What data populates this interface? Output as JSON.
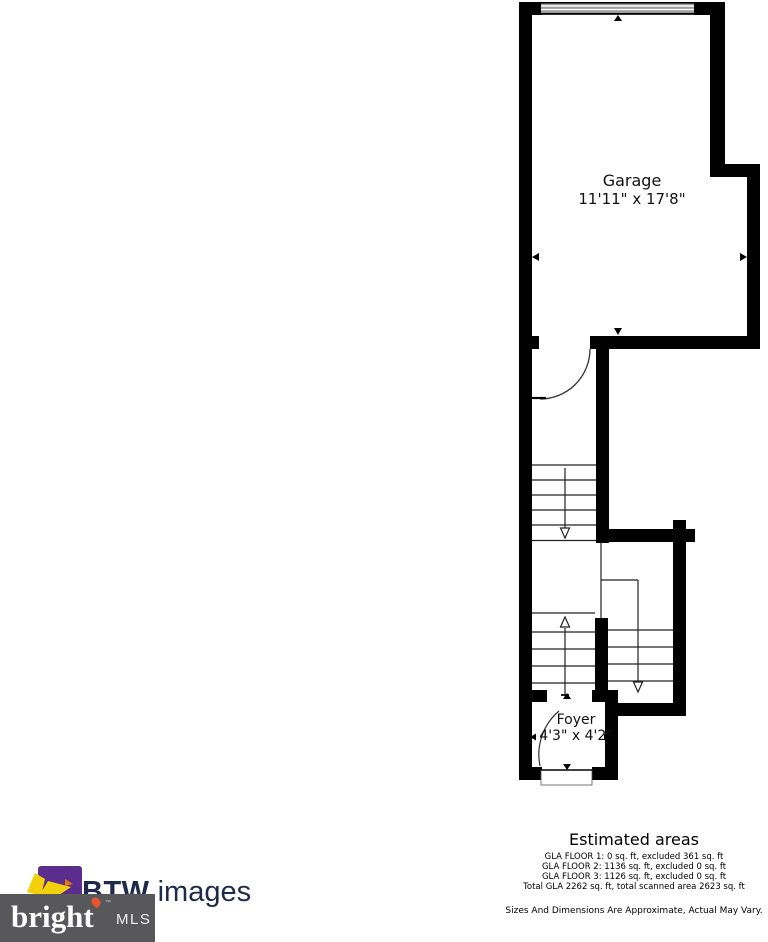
{
  "floor_plan": {
    "rooms": [
      {
        "label": "Garage",
        "dimensions": "11'11\" x 17'8\""
      },
      {
        "label": "Foyer",
        "dimensions": "4'3\" x 4'2\""
      }
    ],
    "features": [
      "garage-door",
      "stairs-upper-flight",
      "stairs-lower-left-flight",
      "stairs-lower-right-flight",
      "interior-door",
      "front-door"
    ]
  },
  "estimated_areas": {
    "title": "Estimated areas",
    "lines": [
      "GLA FLOOR 1: 0 sq. ft, excluded 361 sq. ft",
      "GLA FLOOR 2: 1136 sq. ft, excluded 0 sq. ft",
      "GLA FLOOR 3: 1126 sq. ft, excluded 0 sq. ft",
      "Total GLA 2262 sq. ft, total scanned area 2623 sq. ft"
    ]
  },
  "disclaimer": "Sizes And Dimensions Are Approximate, Actual May Vary.",
  "branding": {
    "company_bold": "BTW",
    "company_rest": " images",
    "mls_wordmark": "bright",
    "mls_tm": "™",
    "mls_label": "MLS"
  },
  "colors": {
    "wall_black": "#000000",
    "garage_door_gray": "#9e9e9e",
    "logo_purple": "#5b2d8c",
    "logo_yellow": "#f2d10a",
    "logo_orange": "#e07b10",
    "flame_orange": "#e8542b",
    "company_navy": "#1e2a49",
    "mls_box_gray": "#58585b"
  }
}
